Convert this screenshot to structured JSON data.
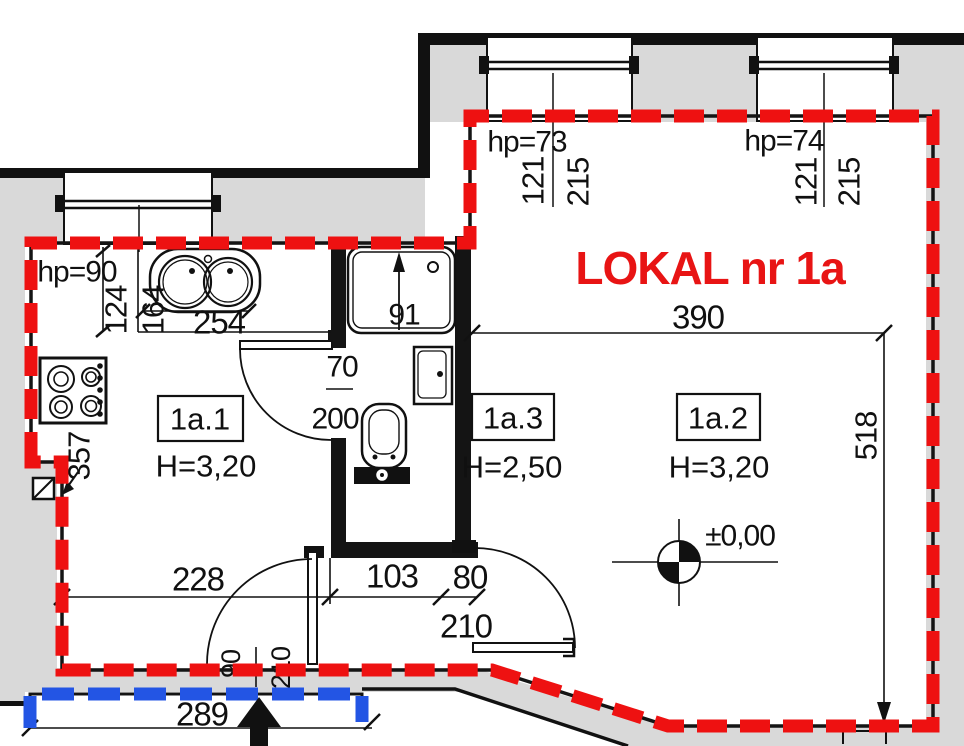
{
  "title": {
    "label": "LOKAL nr 1a"
  },
  "rooms": [
    {
      "id": "1a.1",
      "ceiling": "H=3,20"
    },
    {
      "id": "1a.3",
      "ceiling": "H=2,50"
    },
    {
      "id": "1a.2",
      "ceiling": "H=3,20"
    }
  ],
  "windows": {
    "kitchen": {
      "parapet": "hp=90",
      "width": "124"
    },
    "top_left": {
      "parapet": "hp=73",
      "size_w": "121",
      "size_h": "215"
    },
    "top_right": {
      "parapet": "hp=74",
      "size_w": "121",
      "size_h": "215"
    }
  },
  "doors": {
    "bathroom": {
      "width": "70",
      "height": "200"
    },
    "entrance": {
      "width": "90",
      "height": "210"
    },
    "room2": {
      "width": "80",
      "height": "210"
    }
  },
  "dimensions": {
    "counter_length": "254",
    "counter_depth": "164",
    "kitchen_left": "357",
    "shower_width": "91",
    "room_width": "390",
    "room_depth": "518",
    "bottom_a": "228",
    "bottom_b": "103",
    "entrance_span": "289"
  },
  "level": {
    "label": "±0,00"
  },
  "colors": {
    "boundary_red": "#ee1111",
    "boundary_blue": "#2355e4",
    "wall_fill": "#d9d9d9",
    "line": "#111111"
  }
}
